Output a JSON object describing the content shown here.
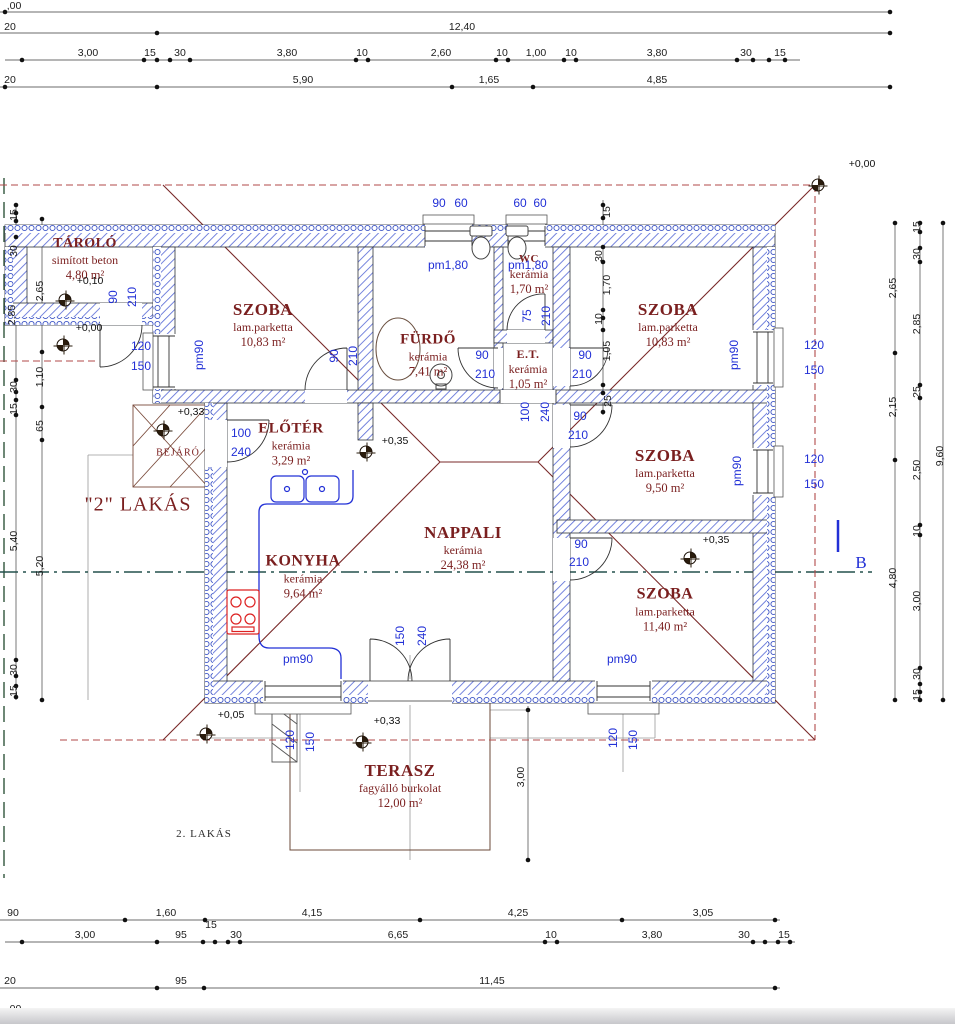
{
  "drawing": {
    "unit_labels": {
      "lakas2_quoted": "\"2\" LAKÁS",
      "lakas2_small": "2. LAKÁS",
      "bejaro": "BEJÁRÓ",
      "section_letter": "B"
    },
    "rooms": [
      {
        "id": "tarolo",
        "name": "TÁROLÓ",
        "finish": "simított beton",
        "area": "4,80 m²",
        "cx": 85,
        "cy": 259,
        "nfs": 14
      },
      {
        "id": "szoba-tl",
        "name": "SZOBA",
        "finish": "lam.parketta",
        "area": "10,83 m²",
        "cx": 263,
        "cy": 325,
        "nfs": 17
      },
      {
        "id": "furdo",
        "name": "FÜRDŐ",
        "finish": "kerámia",
        "area": "7,41 m²",
        "cx": 428,
        "cy": 355,
        "nfs": 15
      },
      {
        "id": "wc",
        "name": "WC",
        "finish": "kerámia",
        "area": "1,70 m²",
        "cx": 529,
        "cy": 275,
        "nfs": 11
      },
      {
        "id": "szoba-tr",
        "name": "SZOBA",
        "finish": "lam.parketta",
        "area": "10,83 m²",
        "cx": 668,
        "cy": 325,
        "nfs": 17
      },
      {
        "id": "et",
        "name": "E.T.",
        "finish": "kerámia",
        "area": "1,05 m²",
        "cx": 528,
        "cy": 370,
        "nfs": 12
      },
      {
        "id": "eloter",
        "name": "ELŐTÉR",
        "finish": "kerámia",
        "area": "3,29 m²",
        "cx": 291,
        "cy": 444,
        "nfs": 15
      },
      {
        "id": "szoba-mr",
        "name": "SZOBA",
        "finish": "lam.parketta",
        "area": "9,50 m²",
        "cx": 665,
        "cy": 471,
        "nfs": 17
      },
      {
        "id": "nappali",
        "name": "NAPPALI",
        "finish": "kerámia",
        "area": "24,38 m²",
        "cx": 463,
        "cy": 548,
        "nfs": 17
      },
      {
        "id": "konyha",
        "name": "KONYHA",
        "finish": "kerámia",
        "area": "9,64 m²",
        "cx": 303,
        "cy": 577,
        "nfs": 16
      },
      {
        "id": "szoba-br",
        "name": "SZOBA",
        "finish": "lam.parketta",
        "area": "11,40 m²",
        "cx": 665,
        "cy": 610,
        "nfs": 16
      },
      {
        "id": "terasz",
        "name": "TERASZ",
        "finish": "fagyálló burkolat",
        "area": "12,00 m²",
        "cx": 400,
        "cy": 786,
        "nfs": 17
      }
    ],
    "level_marks": [
      {
        "text": "+0,10",
        "tx": 90,
        "ty": 281,
        "mx": 65,
        "my": 300
      },
      {
        "text": "+0,00",
        "tx": 89,
        "ty": 328,
        "mx": 63,
        "my": 345
      },
      {
        "text": "+0,33",
        "tx": 191,
        "ty": 412,
        "mx": 163,
        "my": 430
      },
      {
        "text": "+0,35",
        "tx": 395,
        "ty": 441,
        "mx": 366,
        "my": 452
      },
      {
        "text": "+0,35",
        "tx": 716,
        "ty": 540,
        "mx": 690,
        "my": 558
      },
      {
        "text": "+0,05",
        "tx": 231,
        "ty": 715,
        "mx": 206,
        "my": 734
      },
      {
        "text": "+0,33",
        "tx": 387,
        "ty": 721,
        "mx": 362,
        "my": 742
      },
      {
        "text": "+0,00",
        "tx": 862,
        "ty": 164,
        "mx": 818,
        "my": 185
      }
    ],
    "opening_labels": [
      {
        "t": "90",
        "x": 113,
        "y": 297,
        "r": 1
      },
      {
        "t": "210",
        "x": 132,
        "y": 297,
        "r": 1
      },
      {
        "t": "90",
        "x": 334,
        "y": 356,
        "r": 1
      },
      {
        "t": "210",
        "x": 353,
        "y": 356,
        "r": 1
      },
      {
        "t": "120",
        "x": 141,
        "y": 346
      },
      {
        "t": "150",
        "x": 141,
        "y": 366
      },
      {
        "t": "pm90",
        "x": 199,
        "y": 355,
        "r": 1
      },
      {
        "t": "90",
        "x": 439,
        "y": 203
      },
      {
        "t": "60",
        "x": 461,
        "y": 203
      },
      {
        "t": "60",
        "x": 520,
        "y": 203
      },
      {
        "t": "60",
        "x": 540,
        "y": 203
      },
      {
        "t": "pm1,80",
        "x": 448,
        "y": 265
      },
      {
        "t": "pm1,80",
        "x": 528,
        "y": 265
      },
      {
        "t": "75",
        "x": 527,
        "y": 316,
        "r": 1
      },
      {
        "t": "210",
        "x": 546,
        "y": 316,
        "r": 1
      },
      {
        "t": "90",
        "x": 482,
        "y": 355
      },
      {
        "t": "210",
        "x": 485,
        "y": 374
      },
      {
        "t": "90",
        "x": 585,
        "y": 355
      },
      {
        "t": "210",
        "x": 582,
        "y": 374
      },
      {
        "t": "100",
        "x": 525,
        "y": 412,
        "r": 1
      },
      {
        "t": "240",
        "x": 545,
        "y": 412,
        "r": 1
      },
      {
        "t": "90",
        "x": 580,
        "y": 416
      },
      {
        "t": "210",
        "x": 578,
        "y": 435
      },
      {
        "t": "90",
        "x": 581,
        "y": 544
      },
      {
        "t": "210",
        "x": 579,
        "y": 562
      },
      {
        "t": "pm90",
        "x": 734,
        "y": 355,
        "r": 1
      },
      {
        "t": "120",
        "x": 814,
        "y": 345
      },
      {
        "t": "150",
        "x": 814,
        "y": 370
      },
      {
        "t": "pm90",
        "x": 737,
        "y": 471,
        "r": 1
      },
      {
        "t": "120",
        "x": 814,
        "y": 459
      },
      {
        "t": "150",
        "x": 814,
        "y": 484
      },
      {
        "t": "100",
        "x": 241,
        "y": 433
      },
      {
        "t": "240",
        "x": 241,
        "y": 452
      },
      {
        "t": "150",
        "x": 400,
        "y": 636,
        "r": 1
      },
      {
        "t": "240",
        "x": 422,
        "y": 636,
        "r": 1
      },
      {
        "t": "pm90",
        "x": 298,
        "y": 659
      },
      {
        "t": "120",
        "x": 290,
        "y": 740,
        "r": 1
      },
      {
        "t": "150",
        "x": 310,
        "y": 742,
        "r": 1
      },
      {
        "t": "pm90",
        "x": 622,
        "y": 659
      },
      {
        "t": "120",
        "x": 613,
        "y": 738,
        "r": 1
      },
      {
        "t": "150",
        "x": 633,
        "y": 740,
        "r": 1
      }
    ],
    "dim_labels": [
      {
        "t": ",00",
        "x": 14,
        "y": 6
      },
      {
        "t": "20",
        "x": 10,
        "y": 27
      },
      {
        "t": "12,40",
        "x": 462,
        "y": 27
      },
      {
        "t": "3,00",
        "x": 88,
        "y": 53
      },
      {
        "t": "15",
        "x": 150,
        "y": 53
      },
      {
        "t": "30",
        "x": 180,
        "y": 53
      },
      {
        "t": "3,80",
        "x": 287,
        "y": 53
      },
      {
        "t": "10",
        "x": 362,
        "y": 53
      },
      {
        "t": "2,60",
        "x": 441,
        "y": 53
      },
      {
        "t": "10",
        "x": 502,
        "y": 53
      },
      {
        "t": "1,00",
        "x": 536,
        "y": 53
      },
      {
        "t": "10",
        "x": 571,
        "y": 53
      },
      {
        "t": "3,80",
        "x": 657,
        "y": 53
      },
      {
        "t": "30",
        "x": 746,
        "y": 53
      },
      {
        "t": "15",
        "x": 780,
        "y": 53
      },
      {
        "t": "20",
        "x": 10,
        "y": 80
      },
      {
        "t": "5,90",
        "x": 303,
        "y": 80
      },
      {
        "t": "1,65",
        "x": 489,
        "y": 80
      },
      {
        "t": "4,85",
        "x": 657,
        "y": 80
      },
      {
        "t": "90",
        "x": 13,
        "y": 913
      },
      {
        "t": "1,60",
        "x": 166,
        "y": 913
      },
      {
        "t": "4,15",
        "x": 312,
        "y": 913
      },
      {
        "t": "4,25",
        "x": 518,
        "y": 913
      },
      {
        "t": "3,05",
        "x": 703,
        "y": 913
      },
      {
        "t": "3,00",
        "x": 85,
        "y": 935
      },
      {
        "t": "95",
        "x": 181,
        "y": 935
      },
      {
        "t": "15",
        "x": 211,
        "y": 925
      },
      {
        "t": "30",
        "x": 236,
        "y": 935
      },
      {
        "t": "6,65",
        "x": 398,
        "y": 935
      },
      {
        "t": "10",
        "x": 551,
        "y": 935
      },
      {
        "t": "3,80",
        "x": 652,
        "y": 935
      },
      {
        "t": "30",
        "x": 744,
        "y": 935
      },
      {
        "t": "15",
        "x": 784,
        "y": 935
      },
      {
        "t": "20",
        "x": 10,
        "y": 981
      },
      {
        "t": "95",
        "x": 181,
        "y": 981
      },
      {
        "t": "11,45",
        "x": 492,
        "y": 981
      },
      {
        "t": ",00",
        "x": 14,
        "y": 1009
      },
      {
        "t": "2,65",
        "x": 893,
        "y": 288,
        "r": 1
      },
      {
        "t": "2,15",
        "x": 893,
        "y": 407,
        "r": 1
      },
      {
        "t": "4,80",
        "x": 893,
        "y": 578,
        "r": 1
      },
      {
        "t": "15",
        "x": 917,
        "y": 227,
        "r": 1
      },
      {
        "t": "30",
        "x": 917,
        "y": 254,
        "r": 1
      },
      {
        "t": "2,85",
        "x": 917,
        "y": 324,
        "r": 1
      },
      {
        "t": "25",
        "x": 917,
        "y": 392,
        "r": 1
      },
      {
        "t": "2,50",
        "x": 917,
        "y": 470,
        "r": 1
      },
      {
        "t": "10",
        "x": 917,
        "y": 531,
        "r": 1
      },
      {
        "t": "3,00",
        "x": 917,
        "y": 601,
        "r": 1
      },
      {
        "t": "30",
        "x": 917,
        "y": 674,
        "r": 1
      },
      {
        "t": "15",
        "x": 917,
        "y": 695,
        "r": 1
      },
      {
        "t": "9,60",
        "x": 940,
        "y": 456,
        "r": 1
      },
      {
        "t": "15",
        "x": 14,
        "y": 215,
        "r": 1
      },
      {
        "t": "30",
        "x": 14,
        "y": 251,
        "r": 1
      },
      {
        "t": "2,85",
        "x": 12,
        "y": 315,
        "r": 1
      },
      {
        "t": "30",
        "x": 14,
        "y": 387,
        "r": 1
      },
      {
        "t": "15",
        "x": 14,
        "y": 409,
        "r": 1
      },
      {
        "t": "5,40",
        "x": 14,
        "y": 541,
        "r": 1
      },
      {
        "t": "30",
        "x": 14,
        "y": 670,
        "r": 1
      },
      {
        "t": "15",
        "x": 14,
        "y": 691,
        "r": 1
      },
      {
        "t": "2,65",
        "x": 40,
        "y": 291,
        "r": 1
      },
      {
        "t": "1,10",
        "x": 40,
        "y": 377,
        "r": 1
      },
      {
        "t": "65",
        "x": 40,
        "y": 426,
        "r": 1
      },
      {
        "t": "5,20",
        "x": 40,
        "y": 566,
        "r": 1
      },
      {
        "t": "15",
        "x": 607,
        "y": 212,
        "r": 1
      },
      {
        "t": "30",
        "x": 599,
        "y": 256,
        "r": 1
      },
      {
        "t": "1,70",
        "x": 607,
        "y": 285,
        "r": 1
      },
      {
        "t": "10",
        "x": 599,
        "y": 319,
        "r": 1
      },
      {
        "t": "1,05",
        "x": 607,
        "y": 351,
        "r": 1
      },
      {
        "t": "25",
        "x": 608,
        "y": 401,
        "r": 1
      },
      {
        "t": "3,00",
        "x": 521,
        "y": 777,
        "r": 1
      }
    ],
    "dim_ticks": [
      [
        5,
        12
      ],
      [
        890,
        12
      ],
      [
        157,
        33
      ],
      [
        890,
        33
      ],
      [
        22,
        60
      ],
      [
        144,
        60
      ],
      [
        157,
        60
      ],
      [
        170,
        60
      ],
      [
        190,
        60
      ],
      [
        356,
        60
      ],
      [
        368,
        60
      ],
      [
        496,
        60
      ],
      [
        508,
        60
      ],
      [
        564,
        60
      ],
      [
        576,
        60
      ],
      [
        737,
        60
      ],
      [
        753,
        60
      ],
      [
        769,
        60
      ],
      [
        785,
        60
      ],
      [
        5,
        87
      ],
      [
        157,
        87
      ],
      [
        452,
        87
      ],
      [
        533,
        87
      ],
      [
        890,
        87
      ],
      [
        125,
        920
      ],
      [
        205,
        920
      ],
      [
        420,
        920
      ],
      [
        622,
        920
      ],
      [
        775,
        920
      ],
      [
        22,
        942
      ],
      [
        157,
        942
      ],
      [
        203,
        942
      ],
      [
        215,
        942
      ],
      [
        228,
        942
      ],
      [
        240,
        942
      ],
      [
        545,
        942
      ],
      [
        557,
        942
      ],
      [
        753,
        942
      ],
      [
        765,
        942
      ],
      [
        778,
        942
      ],
      [
        790,
        942
      ],
      [
        157,
        988
      ],
      [
        204,
        988
      ],
      [
        775,
        988
      ],
      [
        775,
        1016
      ],
      [
        890,
        1016
      ],
      [
        895,
        223
      ],
      [
        895,
        353
      ],
      [
        895,
        460
      ],
      [
        895,
        700
      ],
      [
        920,
        223
      ],
      [
        920,
        232
      ],
      [
        920,
        248
      ],
      [
        920,
        262
      ],
      [
        920,
        385
      ],
      [
        920,
        398
      ],
      [
        920,
        525
      ],
      [
        920,
        535
      ],
      [
        920,
        668
      ],
      [
        920,
        684
      ],
      [
        920,
        692
      ],
      [
        920,
        700
      ],
      [
        943,
        223
      ],
      [
        943,
        700
      ],
      [
        16,
        205
      ],
      [
        16,
        213
      ],
      [
        16,
        221
      ],
      [
        16,
        237
      ],
      [
        16,
        380
      ],
      [
        16,
        392
      ],
      [
        16,
        400
      ],
      [
        16,
        415
      ],
      [
        16,
        660
      ],
      [
        16,
        676
      ],
      [
        16,
        686
      ],
      [
        16,
        697
      ],
      [
        42,
        219
      ],
      [
        42,
        352
      ],
      [
        42,
        407
      ],
      [
        42,
        440
      ],
      [
        42,
        700
      ],
      [
        603,
        205
      ],
      [
        603,
        218
      ],
      [
        603,
        247
      ],
      [
        603,
        262
      ],
      [
        603,
        310
      ],
      [
        603,
        318
      ],
      [
        603,
        330
      ],
      [
        603,
        385
      ],
      [
        603,
        393
      ],
      [
        603,
        412
      ],
      [
        528,
        710
      ],
      [
        528,
        860
      ]
    ]
  }
}
